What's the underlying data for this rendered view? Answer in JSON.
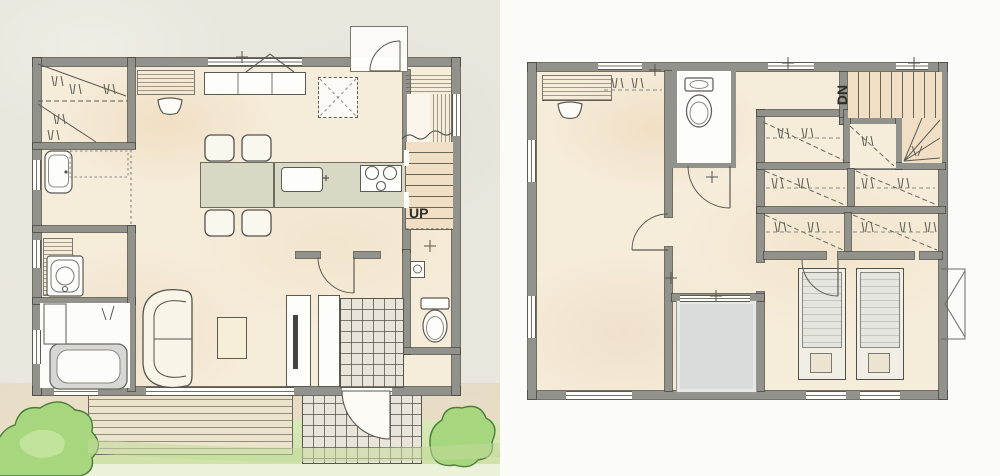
{
  "labels": {
    "floor1_stairs": "UP",
    "floor2_stairs": "DN"
  },
  "colors": {
    "paper": "#e9e6de",
    "paper_right": "#fbfbf8",
    "floor": "#f6ecda",
    "warm": "#f0dfc4",
    "wall": "#92928c",
    "wall_dark": "#56554f",
    "line": "#5b5a53",
    "island": "#d8d8c5",
    "white": "#fdfdfa",
    "balcony": "#d9dcdb",
    "deck": "#ece3cd",
    "tile": "#e9e4d9",
    "path_beige": "#e6dcc6",
    "lawn": "#cfe1a8",
    "lawn_light": "#ebf2da",
    "tree": "#a6d67e",
    "tree_dark": "#4d7b3a",
    "bed": "#e5e5e0",
    "text": "#2d2c28"
  }
}
